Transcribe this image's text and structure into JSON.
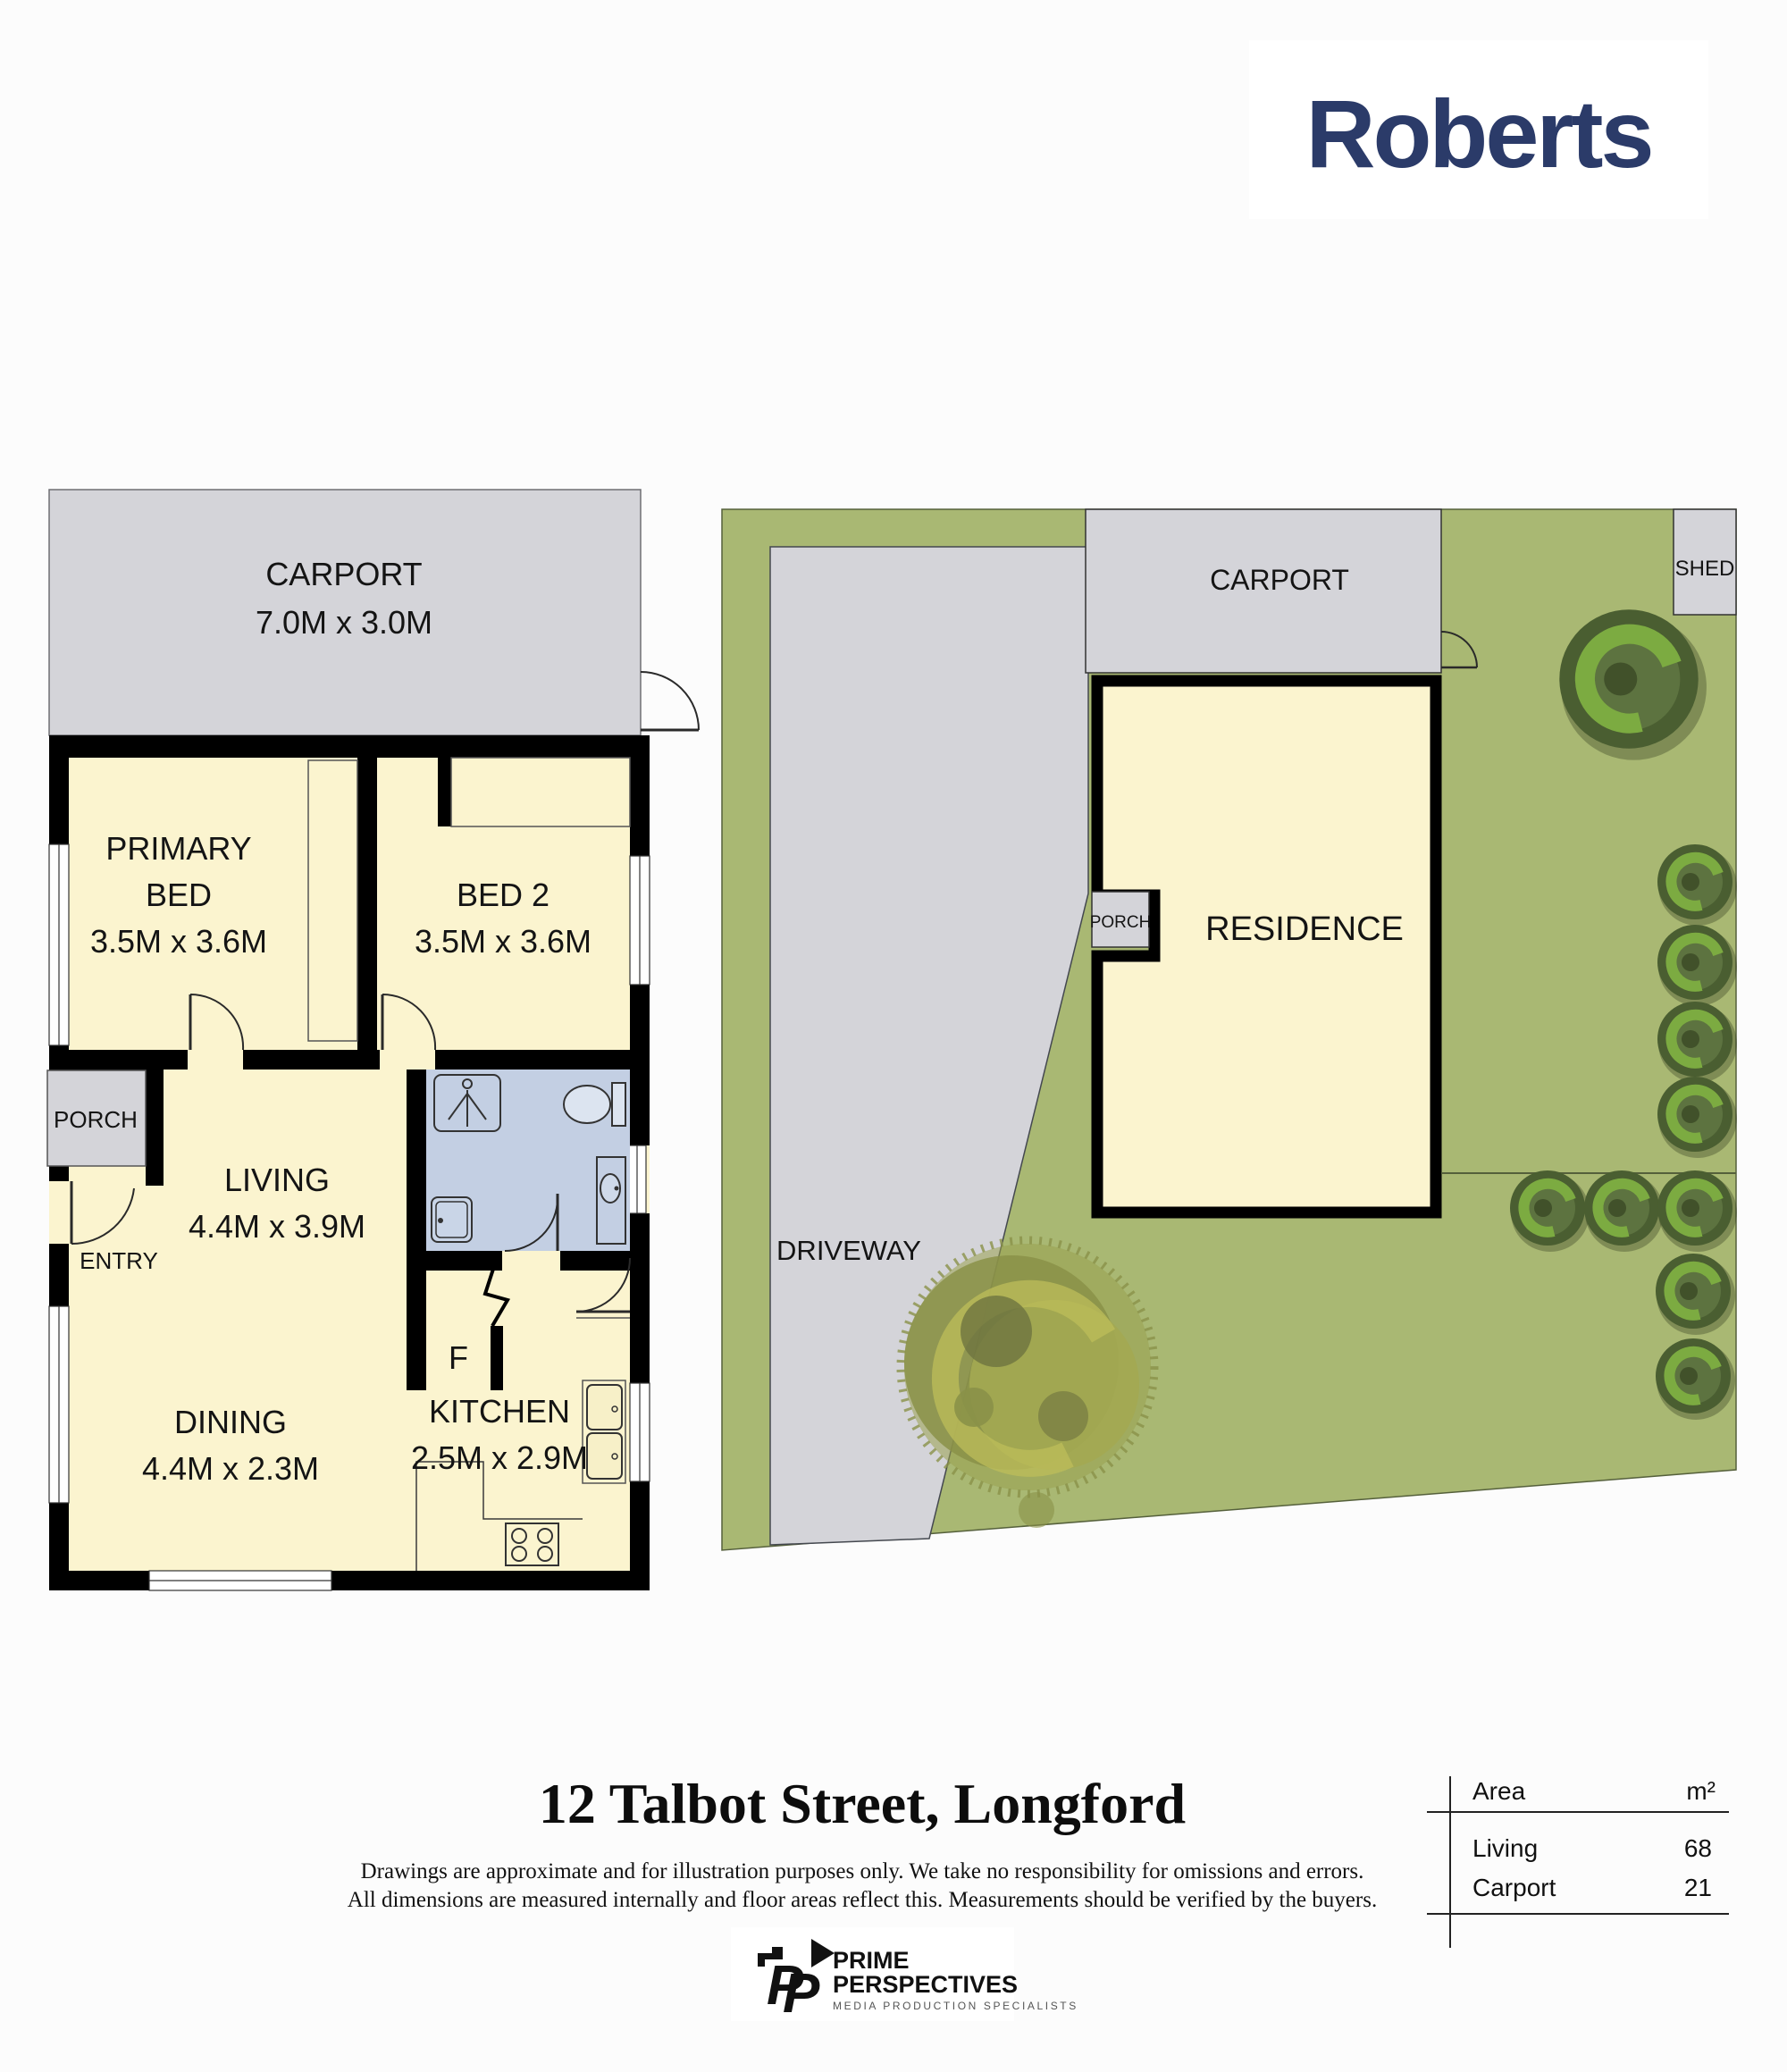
{
  "page": {
    "background": "#FCFCFC"
  },
  "brand": {
    "name": "Roberts",
    "color": "#2B3B69"
  },
  "floor_plan": {
    "carport": {
      "label": "CARPORT",
      "dims": "7.0M x 3.0M"
    },
    "primary_bed": {
      "label_line1": "PRIMARY",
      "label_line2": "BED",
      "dims": "3.5M x 3.6M"
    },
    "bed_2": {
      "label": "BED 2",
      "dims": "3.5M x 3.6M"
    },
    "porch": {
      "label": "PORCH"
    },
    "entry": {
      "label": "ENTRY"
    },
    "living": {
      "label": "LIVING",
      "dims": "4.4M x 3.9M"
    },
    "dining": {
      "label": "DINING",
      "dims": "4.4M x 2.3M"
    },
    "kitchen": {
      "label": "KITCHEN",
      "dims": "2.5M x 2.9M"
    },
    "fridge": {
      "label": "F"
    }
  },
  "site_plan": {
    "carport": {
      "label": "CARPORT"
    },
    "shed": {
      "label": "SHED"
    },
    "residence": {
      "label": "RESIDENCE"
    },
    "porch": {
      "label": "PORCH"
    },
    "driveway": {
      "label": "DRIVEWAY"
    }
  },
  "footer": {
    "address": "12 Talbot Street, Longford",
    "disclaimer_line1": "Drawings are approximate and for illustration purposes only. We take no responsibility for omissions and errors.",
    "disclaimer_line2": "All dimensions are measured internally and floor areas reflect this. Measurements should be verified by the buyers.",
    "area_table": {
      "header_label": "Area",
      "header_unit": "m²",
      "rows": [
        {
          "label": "Living",
          "value": "68"
        },
        {
          "label": "Carport",
          "value": "21"
        }
      ]
    }
  },
  "producer": {
    "name_line1": "PRIME",
    "name_line2": "PERSPECTIVES",
    "tagline": "MEDIA PRODUCTION SPECIALISTS"
  },
  "colors": {
    "wall": "#000000",
    "room_fill": "#FBF4CF",
    "wet_fill": "#C3CFE3",
    "concrete": "#D4D4D9",
    "lot_green": "#A9B873",
    "bush_dark": "#4A5E31",
    "bush_mid": "#5D7340",
    "bush_light": "#7CAB41",
    "tree_yellow": "#99A04F",
    "navy": "#2B3B69"
  }
}
